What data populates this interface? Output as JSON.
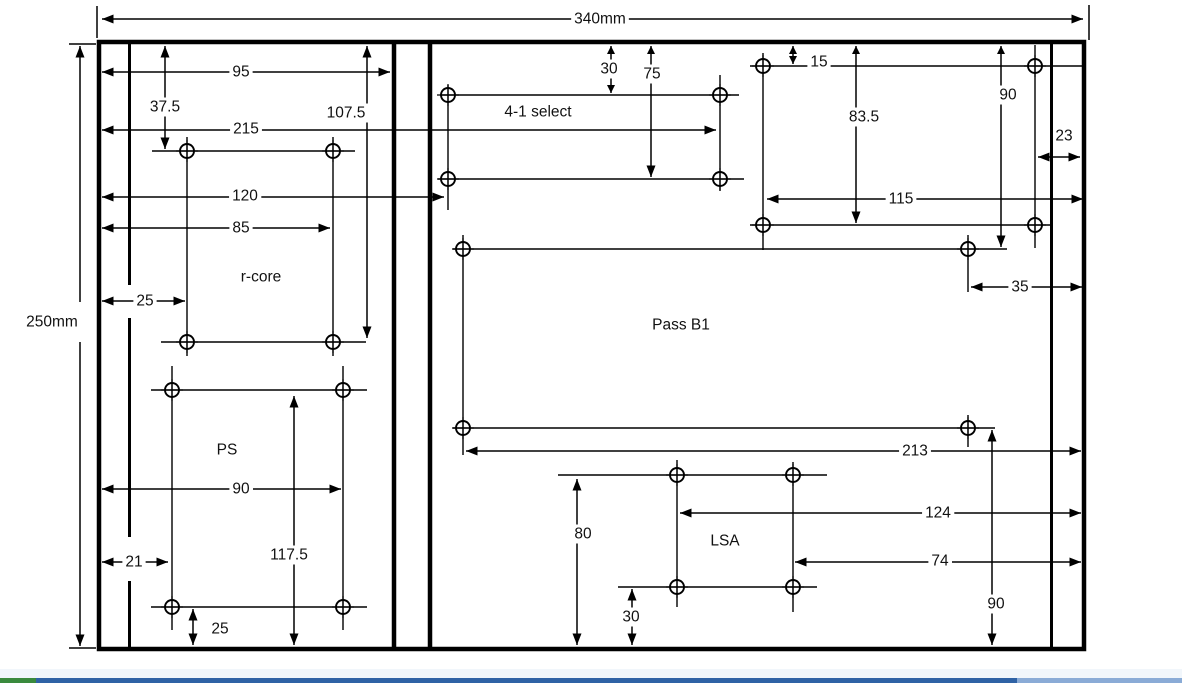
{
  "drawing": {
    "overall": {
      "width_label": "340mm",
      "height_label": "250mm"
    },
    "rcore": {
      "label": "r-core",
      "dims": {
        "d95": "95",
        "d37_5": "37.5",
        "d215": "215",
        "d107_5": "107.5",
        "d120": "120",
        "d85": "85",
        "d25": "25"
      }
    },
    "ps": {
      "label": "PS",
      "dims": {
        "d90": "90",
        "d21": "21",
        "d117_5": "117.5",
        "d25": "25"
      }
    },
    "select41": {
      "label": "4-1 select",
      "dims": {
        "d30": "30",
        "d75": "75"
      }
    },
    "topright": {
      "dims": {
        "d15": "15",
        "d83_5": "83.5",
        "d90": "90",
        "d23": "23",
        "d115": "115"
      }
    },
    "passb1": {
      "label": "Pass B1",
      "dims": {
        "d35": "35",
        "d213": "213",
        "d90": "90"
      }
    },
    "lsa": {
      "label": "LSA",
      "dims": {
        "d80": "80",
        "d124": "124",
        "d74": "74",
        "d30": "30"
      }
    }
  },
  "footer": {
    "band": "#f1f6fb",
    "green": "#3a8a3d",
    "blue": "#2f62a5",
    "light_blue": "#8aabd6"
  }
}
